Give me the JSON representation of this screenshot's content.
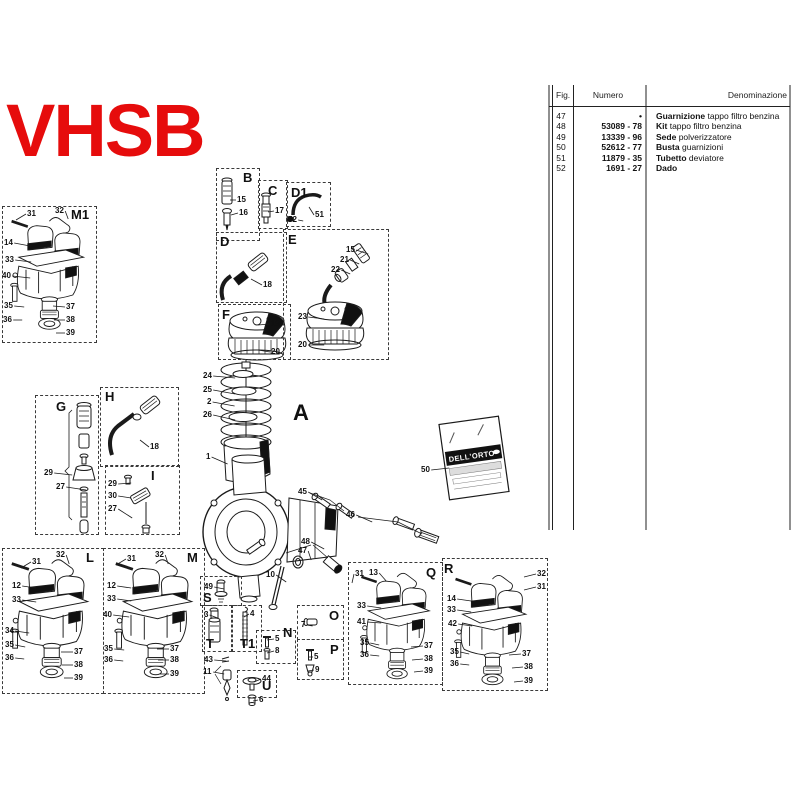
{
  "title": "VHSB",
  "colors": {
    "title": "#e60c0c",
    "line": "#1a1a1a"
  },
  "gasket_bag": {
    "brand": "DELL'ORTO"
  },
  "table": {
    "headers": [
      "Fig.",
      "Numero",
      "Denominazione"
    ],
    "rows": [
      {
        "fig": "47",
        "numero": "•",
        "den_bold": "Guarnizione",
        "den_rest": " tappo filtro benzina"
      },
      {
        "fig": "48",
        "numero": "53089 - 78",
        "den_bold": "Kit",
        "den_rest": " tappo filtro benzina"
      },
      {
        "fig": "49",
        "numero": "13339 - 96",
        "den_bold": "Sede",
        "den_rest": " polverizzatore"
      },
      {
        "fig": "50",
        "numero": "52612 - 77",
        "den_bold": "Busta",
        "den_rest": " guarnizioni"
      },
      {
        "fig": "51",
        "numero": "11879 - 35",
        "den_bold": "Tubetto",
        "den_rest": " deviatore"
      },
      {
        "fig": "52",
        "numero": "1691 - 27",
        "den_bold": "Dado",
        "den_rest": ""
      }
    ]
  },
  "sections": [
    {
      "letter": "M1",
      "lx": 71,
      "ly": 208,
      "box": [
        2,
        206,
        93,
        135
      ],
      "labels": [
        {
          "t": "31",
          "x": 27,
          "y": 210,
          "dx": -10,
          "dy": 6
        },
        {
          "t": "32",
          "x": 55,
          "y": 207,
          "dx": 3,
          "dy": 8
        },
        {
          "t": "14",
          "x": 4,
          "y": 239,
          "dx": 16,
          "dy": 3
        },
        {
          "t": "33",
          "x": 5,
          "y": 256,
          "dx": 16,
          "dy": 2
        },
        {
          "t": "40",
          "x": 2,
          "y": 272,
          "dx": 18,
          "dy": 2
        },
        {
          "t": "35",
          "x": 4,
          "y": 302,
          "dx": 10,
          "dy": 1
        },
        {
          "t": "36",
          "x": 3,
          "y": 316,
          "dx": 9,
          "dy": 0
        },
        {
          "t": "37",
          "x": 66,
          "y": 303,
          "dx": -12,
          "dy": -1
        },
        {
          "t": "38",
          "x": 66,
          "y": 316,
          "dx": -11,
          "dy": 0
        },
        {
          "t": "39",
          "x": 66,
          "y": 329,
          "dx": -9,
          "dy": 0
        }
      ]
    },
    {
      "letter": "B",
      "lx": 243,
      "ly": 171,
      "box": [
        216,
        168,
        42,
        71
      ],
      "labels": [
        {
          "t": "15",
          "x": 237,
          "y": 196,
          "dx": -6,
          "dy": 0
        },
        {
          "t": "16",
          "x": 239,
          "y": 209,
          "dx": -7,
          "dy": 2
        }
      ]
    },
    {
      "letter": "C",
      "lx": 268,
      "ly": 184,
      "box": [
        258,
        180,
        28,
        47
      ],
      "labels": [
        {
          "t": "17",
          "x": 275,
          "y": 207,
          "dx": -6,
          "dy": 1
        }
      ]
    },
    {
      "letter": "D1",
      "lx": 291,
      "ly": 186,
      "box": [
        286,
        182,
        43,
        43
      ],
      "labels": [
        {
          "t": "52",
          "x": 288,
          "y": 216,
          "dx": 5,
          "dy": 1
        },
        {
          "t": "51",
          "x": 315,
          "y": 211,
          "dx": -5,
          "dy": -8
        }
      ]
    },
    {
      "letter": "D",
      "lx": 220,
      "ly": 235,
      "box": [
        216,
        232,
        69,
        69
      ],
      "labels": [
        {
          "t": "18",
          "x": 263,
          "y": 281,
          "dx": -11,
          "dy": -6
        }
      ]
    },
    {
      "letter": "E",
      "lx": 288,
      "ly": 233,
      "box": [
        283,
        229,
        104,
        129
      ],
      "labels": [
        {
          "t": "15",
          "x": 346,
          "y": 246,
          "dx": 12,
          "dy": 4
        },
        {
          "t": "21",
          "x": 340,
          "y": 256,
          "dx": 9,
          "dy": 4
        },
        {
          "t": "22",
          "x": 331,
          "y": 266,
          "dx": 9,
          "dy": 4
        },
        {
          "t": "23",
          "x": 298,
          "y": 313,
          "dx": 16,
          "dy": 2
        },
        {
          "t": "20",
          "x": 298,
          "y": 341,
          "dx": 16,
          "dy": 0
        }
      ]
    },
    {
      "letter": "F",
      "lx": 222,
      "ly": 308,
      "box": [
        218,
        304,
        71,
        54
      ],
      "labels": [
        {
          "t": "19",
          "x": 271,
          "y": 320,
          "dx": -12,
          "dy": 1
        },
        {
          "t": "20",
          "x": 271,
          "y": 348,
          "dx": -12,
          "dy": -2
        }
      ]
    },
    {
      "letter": "G",
      "lx": 56,
      "ly": 400,
      "box": [
        35,
        395,
        62,
        138
      ],
      "labels": [
        {
          "t": "29",
          "x": 44,
          "y": 469,
          "dx": 18,
          "dy": 2
        },
        {
          "t": "27",
          "x": 56,
          "y": 483,
          "dx": 20,
          "dy": 3
        }
      ]
    },
    {
      "letter": "H",
      "lx": 105,
      "ly": 390,
      "box": [
        100,
        387,
        77,
        78
      ],
      "labels": [
        {
          "t": "18",
          "x": 150,
          "y": 443,
          "dx": -9,
          "dy": -7
        }
      ]
    },
    {
      "letter": "I",
      "lx": 151,
      "ly": 469,
      "box": [
        105,
        465,
        73,
        68
      ],
      "labels": [
        {
          "t": "29",
          "x": 108,
          "y": 480,
          "dx": 13,
          "dy": -1
        },
        {
          "t": "30",
          "x": 108,
          "y": 492,
          "dx": 13,
          "dy": 2
        },
        {
          "t": "27",
          "x": 108,
          "y": 505,
          "dx": 14,
          "dy": 9
        }
      ]
    },
    {
      "letter": "L",
      "lx": 86,
      "ly": 551,
      "box": [
        2,
        548,
        100,
        144
      ],
      "labels": [
        {
          "t": "31",
          "x": 32,
          "y": 558,
          "dx": -10,
          "dy": 6
        },
        {
          "t": "32",
          "x": 56,
          "y": 551,
          "dx": 3,
          "dy": 9
        },
        {
          "t": "12",
          "x": 12,
          "y": 582,
          "dx": 14,
          "dy": 2
        },
        {
          "t": "33",
          "x": 12,
          "y": 596,
          "dx": 14,
          "dy": 2
        },
        {
          "t": "34",
          "x": 5,
          "y": 627,
          "dx": 14,
          "dy": 2
        },
        {
          "t": "35",
          "x": 5,
          "y": 641,
          "dx": 10,
          "dy": 2
        },
        {
          "t": "36",
          "x": 5,
          "y": 654,
          "dx": 9,
          "dy": 1
        },
        {
          "t": "37",
          "x": 74,
          "y": 648,
          "dx": -12,
          "dy": 0
        },
        {
          "t": "38",
          "x": 74,
          "y": 661,
          "dx": -11,
          "dy": 0
        },
        {
          "t": "39",
          "x": 74,
          "y": 674,
          "dx": -9,
          "dy": 0
        }
      ]
    },
    {
      "letter": "M",
      "lx": 187,
      "ly": 551,
      "box": [
        103,
        548,
        100,
        144
      ],
      "labels": [
        {
          "t": "31",
          "x": 127,
          "y": 555,
          "dx": -10,
          "dy": 6
        },
        {
          "t": "32",
          "x": 155,
          "y": 551,
          "dx": 3,
          "dy": 9
        },
        {
          "t": "12",
          "x": 107,
          "y": 582,
          "dx": 14,
          "dy": 2
        },
        {
          "t": "33",
          "x": 107,
          "y": 595,
          "dx": 14,
          "dy": 2
        },
        {
          "t": "40",
          "x": 103,
          "y": 611,
          "dx": 16,
          "dy": 2
        },
        {
          "t": "35",
          "x": 104,
          "y": 645,
          "dx": 10,
          "dy": 1
        },
        {
          "t": "36",
          "x": 104,
          "y": 656,
          "dx": 9,
          "dy": 1
        },
        {
          "t": "37",
          "x": 170,
          "y": 645,
          "dx": -12,
          "dy": 0
        },
        {
          "t": "38",
          "x": 170,
          "y": 656,
          "dx": -11,
          "dy": 0
        },
        {
          "t": "39",
          "x": 170,
          "y": 670,
          "dx": -9,
          "dy": 0
        }
      ]
    },
    {
      "letter": "S",
      "lx": 203,
      "ly": 591,
      "box": [
        200,
        576,
        40,
        28
      ],
      "labels": [
        {
          "t": "49",
          "x": 204,
          "y": 583,
          "dx": 10,
          "dy": 2
        }
      ]
    },
    {
      "letter": "T",
      "lx": 206,
      "ly": 637,
      "box": [
        202,
        605,
        28,
        45
      ],
      "labels": [
        {
          "t": "3",
          "x": 204,
          "y": 611,
          "dx": 8,
          "dy": 3
        }
      ]
    },
    {
      "letter": "T1",
      "lx": 240,
      "ly": 637,
      "box": [
        232,
        605,
        28,
        45
      ],
      "labels": [
        {
          "t": "4",
          "x": 250,
          "y": 610,
          "dx": -5,
          "dy": 3
        }
      ]
    },
    {
      "letter": "N",
      "lx": 283,
      "ly": 626,
      "box": [
        256,
        630,
        38,
        32
      ],
      "labels": [
        {
          "t": "5",
          "x": 275,
          "y": 635,
          "dx": -7,
          "dy": 1
        },
        {
          "t": "8",
          "x": 275,
          "y": 647,
          "dx": -7,
          "dy": 2
        }
      ]
    },
    {
      "letter": "O",
      "lx": 329,
      "ly": 609,
      "box": [
        297,
        605,
        45,
        33
      ],
      "labels": [
        {
          "t": "7",
          "x": 301,
          "y": 621,
          "dx": 6,
          "dy": 1
        }
      ]
    },
    {
      "letter": "P",
      "lx": 330,
      "ly": 643,
      "box": [
        297,
        639,
        45,
        39
      ],
      "labels": [
        {
          "t": "5",
          "x": 314,
          "y": 653,
          "dx": -5,
          "dy": 0
        },
        {
          "t": "9",
          "x": 315,
          "y": 666,
          "dx": -6,
          "dy": 1
        }
      ]
    },
    {
      "letter": "U",
      "lx": 262,
      "ly": 679,
      "box": [
        237,
        670,
        38,
        26
      ],
      "labels": [
        {
          "t": "44",
          "x": 262,
          "y": 675,
          "dx": -7,
          "dy": 3
        },
        {
          "t": "6",
          "x": 259,
          "y": 696,
          "dx": -5,
          "dy": 1
        }
      ]
    },
    {
      "letter": "Q",
      "lx": 426,
      "ly": 566,
      "box": [
        348,
        562,
        93,
        121
      ],
      "labels": [
        {
          "t": "31",
          "x": 355,
          "y": 570,
          "dx": -2,
          "dy": 9
        },
        {
          "t": "13",
          "x": 369,
          "y": 569,
          "dx": 7,
          "dy": 8
        },
        {
          "t": "33",
          "x": 357,
          "y": 602,
          "dx": 14,
          "dy": 2
        },
        {
          "t": "41",
          "x": 357,
          "y": 618,
          "dx": 14,
          "dy": 1
        },
        {
          "t": "35",
          "x": 360,
          "y": 639,
          "dx": 9,
          "dy": 2
        },
        {
          "t": "36",
          "x": 360,
          "y": 651,
          "dx": 9,
          "dy": 1
        },
        {
          "t": "37",
          "x": 424,
          "y": 642,
          "dx": -12,
          "dy": 1
        },
        {
          "t": "38",
          "x": 424,
          "y": 655,
          "dx": -11,
          "dy": 1
        },
        {
          "t": "39",
          "x": 424,
          "y": 667,
          "dx": -9,
          "dy": 1
        }
      ]
    },
    {
      "letter": "R",
      "lx": 444,
      "ly": 562,
      "box": [
        442,
        558,
        104,
        131
      ],
      "labels": [
        {
          "t": "32",
          "x": 537,
          "y": 570,
          "dx": -12,
          "dy": 3
        },
        {
          "t": "31",
          "x": 537,
          "y": 583,
          "dx": -12,
          "dy": 3
        },
        {
          "t": "14",
          "x": 447,
          "y": 595,
          "dx": 14,
          "dy": 2
        },
        {
          "t": "33",
          "x": 447,
          "y": 606,
          "dx": 14,
          "dy": 2
        },
        {
          "t": "42",
          "x": 448,
          "y": 620,
          "dx": 14,
          "dy": 2
        },
        {
          "t": "35",
          "x": 450,
          "y": 648,
          "dx": 9,
          "dy": 2
        },
        {
          "t": "36",
          "x": 450,
          "y": 660,
          "dx": 9,
          "dy": 1
        },
        {
          "t": "37",
          "x": 522,
          "y": 650,
          "dx": -12,
          "dy": 1
        },
        {
          "t": "38",
          "x": 524,
          "y": 663,
          "dx": -11,
          "dy": 1
        },
        {
          "t": "39",
          "x": 524,
          "y": 677,
          "dx": -9,
          "dy": 1
        }
      ]
    },
    {
      "letter": "A",
      "lx": 293,
      "ly": 402,
      "big": true,
      "box": null,
      "labels": [
        {
          "t": "24",
          "x": 203,
          "y": 372,
          "dx": 22,
          "dy": 2
        },
        {
          "t": "25",
          "x": 203,
          "y": 386,
          "dx": 22,
          "dy": 4
        },
        {
          "t": "2",
          "x": 207,
          "y": 398,
          "dx": 22,
          "dy": 4
        },
        {
          "t": "26",
          "x": 203,
          "y": 411,
          "dx": 22,
          "dy": 5
        },
        {
          "t": "1",
          "x": 206,
          "y": 453,
          "dx": 16,
          "dy": 7
        },
        {
          "t": "10",
          "x": 266,
          "y": 571,
          "dx": 10,
          "dy": 7
        },
        {
          "t": "45",
          "x": 298,
          "y": 488,
          "dx": 14,
          "dy": 8
        },
        {
          "t": "46",
          "x": 346,
          "y": 511,
          "dx": 16,
          "dy": 7
        },
        {
          "t": "48",
          "x": 301,
          "y": 538,
          "dx": 13,
          "dy": 7
        },
        {
          "t": "47",
          "x": 298,
          "y": 547,
          "dx": 3,
          "dy": 9
        },
        {
          "t": "50",
          "x": 421,
          "y": 466,
          "dx": 18,
          "dy": -2
        },
        {
          "t": "43",
          "x": 204,
          "y": 656,
          "dx": 12,
          "dy": 1
        },
        {
          "t": "11",
          "x": 203,
          "y": 668,
          "dx": 11,
          "dy": 2
        }
      ]
    }
  ]
}
